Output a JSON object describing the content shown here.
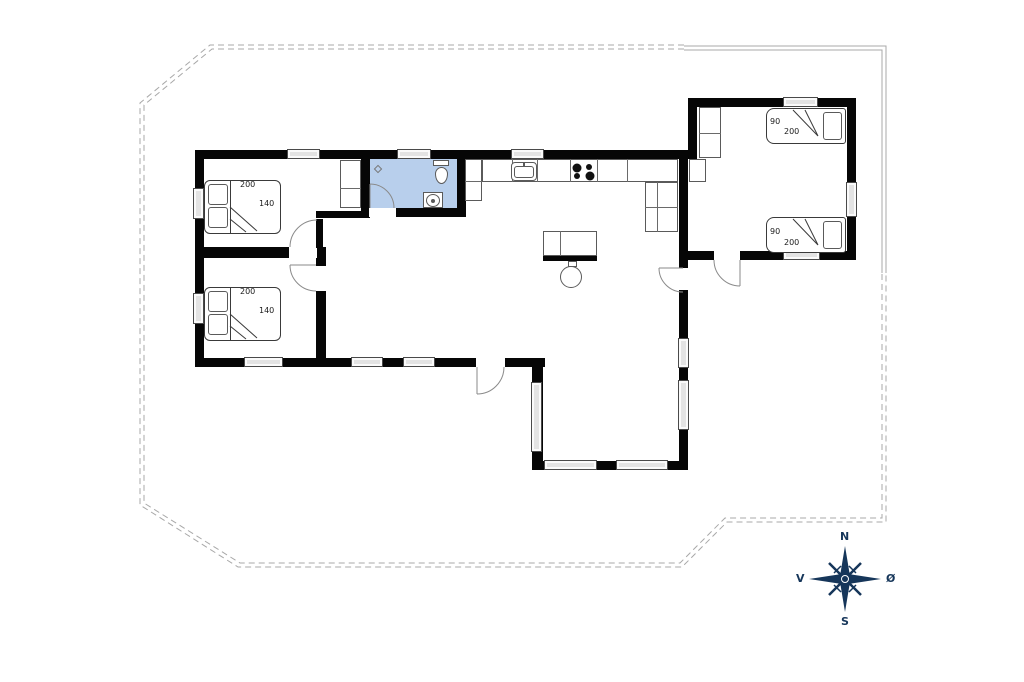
{
  "plan": {
    "bedroom1_bed": {
      "length": "200",
      "width": "140"
    },
    "bedroom2_bed": {
      "length": "200",
      "width": "140"
    },
    "annex_bed_north": {
      "width": "90",
      "length": "200"
    },
    "annex_bed_south": {
      "width": "90",
      "length": "200"
    },
    "compass": {
      "north": "N",
      "east": "Ø",
      "south": "S",
      "west": "V"
    },
    "colors": {
      "wall": "#060606",
      "bathroom_fill": "#b8cfec",
      "window_fill": "#e3e3e3",
      "boundary_line": "#a8a8a8",
      "compass_navy": "#16365a"
    }
  }
}
